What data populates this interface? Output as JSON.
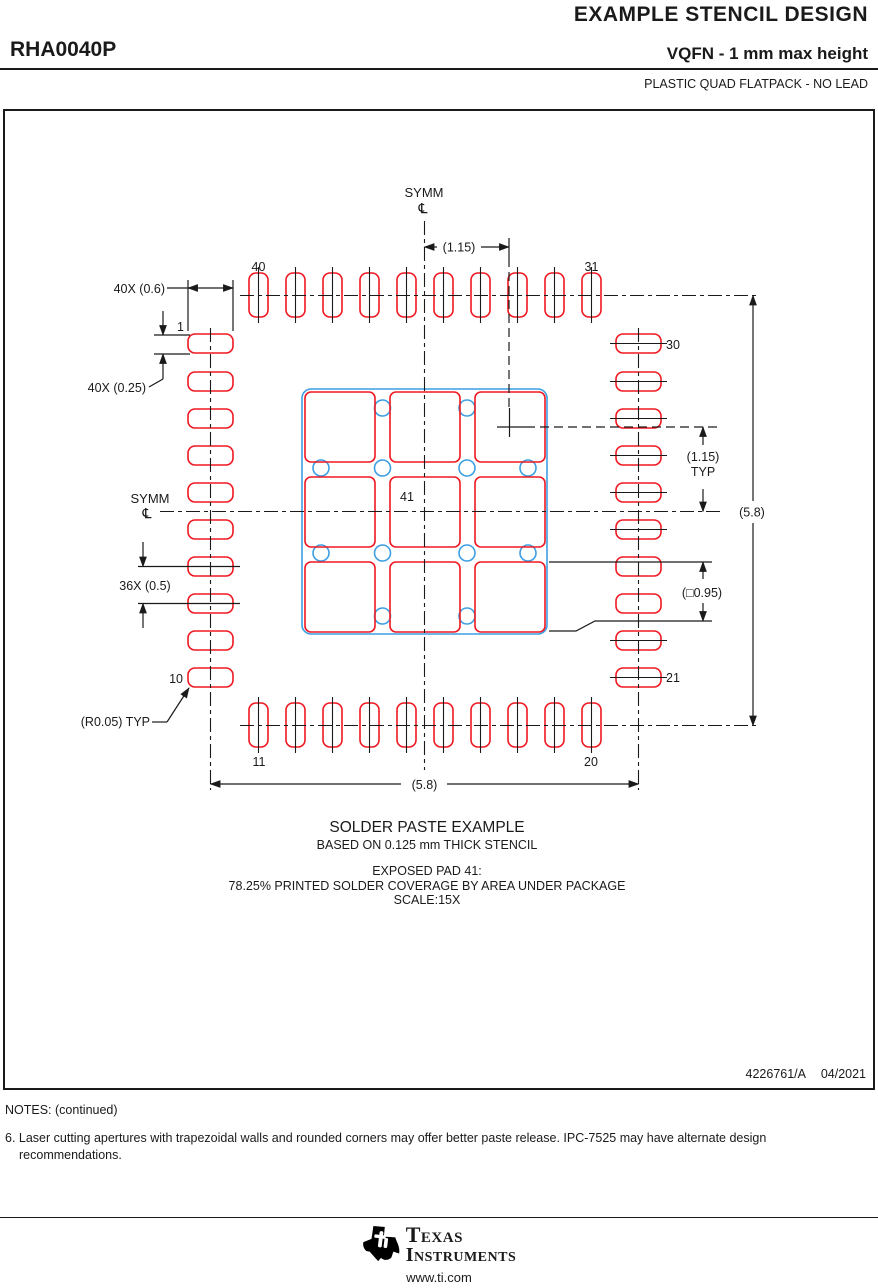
{
  "header": {
    "title": "EXAMPLE STENCIL DESIGN",
    "part_number": "RHA0040P",
    "package_title": "VQFN - 1 mm max height",
    "package_subtitle": "PLASTIC QUAD FLATPACK - NO LEAD"
  },
  "drawing": {
    "symm_top": "SYMM",
    "symm_left": "SYMM",
    "centerline_symbol_top": "℄",
    "centerline_symbol_left": "℄",
    "dim_pitch_top": "(1.15)",
    "dim_pitch_right": "(1.15)",
    "dim_pitch_right_typ": "TYP",
    "dim_pad_length": "40X (0.6)",
    "dim_pad_width": "40X (0.25)",
    "dim_pad_pitch": "36X (0.5)",
    "dim_corner_radius": "(R0.05) TYP",
    "dim_span_right": "(5.8)",
    "dim_span_bottom": "(5.8)",
    "dim_aperture_square": "(□0.95)",
    "pins": {
      "p1": "1",
      "p10": "10",
      "p11": "11",
      "p20": "20",
      "p21": "21",
      "p30": "30",
      "p31": "31",
      "p40": "40",
      "p41": "41"
    }
  },
  "caption": {
    "line1": "SOLDER PASTE EXAMPLE",
    "line2": "BASED ON 0.125 mm THICK STENCIL",
    "line3": "EXPOSED PAD 41:",
    "line4": "78.25% PRINTED SOLDER COVERAGE BY AREA UNDER PACKAGE",
    "line5": "SCALE:15X"
  },
  "title_block": {
    "document_id": "4226761/A",
    "date": "04/2021"
  },
  "notes": {
    "heading": "NOTES: (continued)",
    "note6": "6. Laser cutting apertures with trapezoidal walls and rounded corners may offer better paste release. IPC-7525 may have alternate design recommendations."
  },
  "footer": {
    "brand_line1": "Texas",
    "brand_line2": "Instruments",
    "website": "www.ti.com"
  },
  "colors": {
    "aperture_red": "#f01820",
    "pcb_blue": "#3d9ee2",
    "line_black": "#1a1a1a"
  }
}
